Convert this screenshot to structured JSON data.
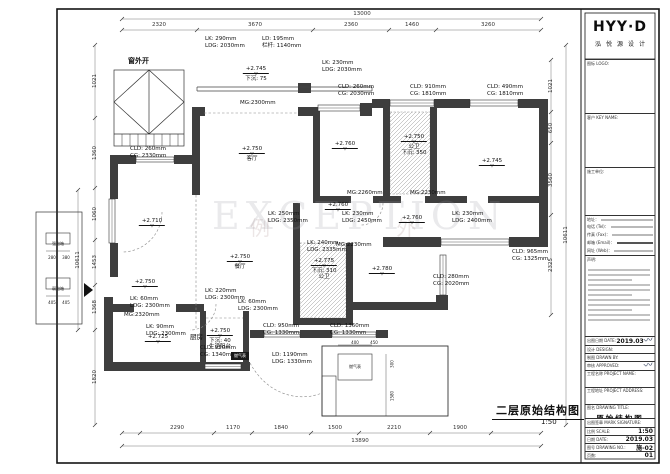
{
  "watermark": {
    "text": "EXCEPTION",
    "cn": "例 外"
  },
  "plan": {
    "title": "二层原始结构图",
    "scale": "1:50",
    "window_note": "窗外开",
    "gas_chip": "燃气表",
    "leaders": [
      {
        "x": 205,
        "y": 36,
        "l1": "LK: 290mm",
        "l2": "LDG: 2030mm"
      },
      {
        "x": 262,
        "y": 36,
        "l1": "LD: 195mm",
        "l2": "栏杆: 1140mm"
      },
      {
        "x": 322,
        "y": 60,
        "l1": "LK: 230mm",
        "l2": "LDG: 2030mm"
      },
      {
        "x": 338,
        "y": 84,
        "l1": "CLD: 260mm",
        "l2": "CG: 2030mm"
      },
      {
        "x": 410,
        "y": 84,
        "l1": "CLD: 910mm",
        "l2": "CG: 1810mm"
      },
      {
        "x": 487,
        "y": 84,
        "l1": "CLD: 490mm",
        "l2": "CG: 1810mm"
      },
      {
        "x": 130,
        "y": 146,
        "l1": "CLD: 260mm",
        "l2": "CG: 2330mm"
      },
      {
        "x": 268,
        "y": 211,
        "l1": "LK: 250mm",
        "l2": "LDG: 2350mm"
      },
      {
        "x": 342,
        "y": 211,
        "l1": "LK: 230mm",
        "l2": "LDG: 2450mm"
      },
      {
        "x": 452,
        "y": 211,
        "l1": "LK: 230mm",
        "l2": "LDG: 2400mm"
      },
      {
        "x": 307,
        "y": 240,
        "l1": "LK: 240mm",
        "l2": "LDG: 2335mm"
      },
      {
        "x": 205,
        "y": 288,
        "l1": "LK: 220mm",
        "l2": "LDG: 2300mm"
      },
      {
        "x": 238,
        "y": 299,
        "l1": "LK: 60mm",
        "l2": "LDG: 2300mm"
      },
      {
        "x": 130,
        "y": 296,
        "l1": "LK: 60mm",
        "l2": "LDG: 2300mm"
      },
      {
        "x": 146,
        "y": 324,
        "l1": "LK: 90mm",
        "l2": "LDG: 2300mm"
      },
      {
        "x": 200,
        "y": 345,
        "l1": "CLD: 950mm",
        "l2": "CG: 1340mm"
      },
      {
        "x": 263,
        "y": 323,
        "l1": "CLD: 950mm",
        "l2": "CG: 1330mm"
      },
      {
        "x": 330,
        "y": 323,
        "l1": "CLD: 1360mm",
        "l2": "CG: 1330mm"
      },
      {
        "x": 272,
        "y": 352,
        "l1": "LD: 1190mm",
        "l2": "LDG: 1330mm"
      },
      {
        "x": 433,
        "y": 274,
        "l1": "CLD: 280mm",
        "l2": "CG: 2020mm"
      },
      {
        "x": 512,
        "y": 249,
        "l1": "CLD: 965mm",
        "l2": "CG: 1325mm"
      }
    ],
    "levels": [
      {
        "x": 256,
        "y": 66,
        "v": "+2.745",
        "sub": [
          "下沉: 75"
        ]
      },
      {
        "x": 252,
        "y": 146,
        "v": "+2.750",
        "sub": [
          "客厅"
        ]
      },
      {
        "x": 152,
        "y": 218,
        "v": "+2.710",
        "sub": []
      },
      {
        "x": 345,
        "y": 141,
        "v": "+2.760",
        "sub": []
      },
      {
        "x": 414,
        "y": 134,
        "v": "+2.750",
        "sub": [
          "公卫",
          "下沉: 350"
        ]
      },
      {
        "x": 492,
        "y": 158,
        "v": "+2.745",
        "sub": []
      },
      {
        "x": 338,
        "y": 202,
        "v": "+2.760",
        "sub": []
      },
      {
        "x": 412,
        "y": 215,
        "v": "+2.760",
        "sub": []
      },
      {
        "x": 240,
        "y": 254,
        "v": "+2.750",
        "sub": [
          "餐厅"
        ]
      },
      {
        "x": 324,
        "y": 258,
        "v": "+2.775",
        "sub": [
          "下沉: 310",
          "公卫"
        ]
      },
      {
        "x": 382,
        "y": 266,
        "v": "+2.780",
        "sub": []
      },
      {
        "x": 145,
        "y": 279,
        "v": "+2.750",
        "sub": []
      },
      {
        "x": 158,
        "y": 334,
        "v": "+2.725",
        "sub": []
      },
      {
        "x": 220,
        "y": 328,
        "v": "+2.750",
        "sub": [
          "下沉: 40",
          "生活阳台"
        ]
      }
    ],
    "mg_labels": [
      {
        "x": 240,
        "y": 100,
        "t": "MG:2300mm"
      },
      {
        "x": 347,
        "y": 190,
        "t": "MG:2260mm"
      },
      {
        "x": 410,
        "y": 190,
        "t": "MG:2230mm"
      },
      {
        "x": 336,
        "y": 242,
        "t": "MG:2230mm"
      },
      {
        "x": 124,
        "y": 312,
        "t": "MG:2320mm"
      }
    ],
    "rooms": [
      {
        "x": 190,
        "y": 331,
        "t": "厨房"
      }
    ],
    "dims": {
      "top_total": "13000",
      "bottom_total": "13890",
      "top": [
        {
          "x": 159,
          "t": "2320"
        },
        {
          "x": 255,
          "t": "3670"
        },
        {
          "x": 351,
          "t": "2360"
        },
        {
          "x": 412,
          "t": "1460"
        },
        {
          "x": 488,
          "t": "3260"
        }
      ],
      "bottom": [
        {
          "x": 177,
          "t": "2290"
        },
        {
          "x": 233,
          "t": "1170"
        },
        {
          "x": 281,
          "t": "1840"
        },
        {
          "x": 335,
          "t": "1500"
        },
        {
          "x": 394,
          "t": "2210"
        },
        {
          "x": 460,
          "t": "1900"
        }
      ],
      "left": [
        {
          "x": 95,
          "y": 81,
          "t": "1021"
        },
        {
          "x": 95,
          "y": 153,
          "t": "1360"
        },
        {
          "x": 95,
          "y": 214,
          "t": "1060"
        },
        {
          "x": 95,
          "y": 262,
          "t": "1453"
        },
        {
          "x": 95,
          "y": 307,
          "t": "1368"
        },
        {
          "x": 95,
          "y": 377,
          "t": "1820"
        },
        {
          "x": 78,
          "y": 260,
          "t": "10611"
        }
      ],
      "right": [
        {
          "x": 551,
          "y": 86,
          "t": "1021"
        },
        {
          "x": 551,
          "y": 128,
          "t": "650"
        },
        {
          "x": 551,
          "y": 180,
          "t": "3560"
        },
        {
          "x": 551,
          "y": 265,
          "t": "2325"
        },
        {
          "x": 566,
          "y": 235,
          "t": "10611"
        }
      ]
    },
    "tiny_labels": [
      {
        "x": 355,
        "y": 340,
        "t": "400"
      },
      {
        "x": 374,
        "y": 340,
        "t": "450"
      },
      {
        "x": 392,
        "y": 364,
        "t": "300",
        "r": 1
      },
      {
        "x": 392,
        "y": 396,
        "t": "1580",
        "r": 1
      },
      {
        "x": 355,
        "y": 364,
        "t": "燃气表"
      },
      {
        "x": 58,
        "y": 241,
        "t": "强电箱"
      },
      {
        "x": 58,
        "y": 286,
        "t": "弱电箱"
      },
      {
        "x": 52,
        "y": 255,
        "t": "280"
      },
      {
        "x": 66,
        "y": 255,
        "t": "380"
      },
      {
        "x": 52,
        "y": 300,
        "t": "405"
      },
      {
        "x": 66,
        "y": 300,
        "t": "405"
      }
    ]
  },
  "titleblock": {
    "logo": "HYY·D",
    "logo_sub": "泓悦源设计",
    "cells": [
      {
        "label": "图标 LOGO:"
      },
      {
        "label": "客户 KEY NAME:"
      },
      {
        "label": "施工单位:"
      }
    ],
    "contact_labels": [
      "地址：",
      "电话 (Tel)：",
      "传真 (Fax)：",
      "邮箱 (Email)：",
      "网址 (Web)："
    ],
    "notes_label": "声明:",
    "fields": [
      {
        "label": "出图日期 DATE:",
        "value": "2019.03",
        "stamp": true
      },
      {
        "label": "设计 DESIGN:",
        "value": ""
      },
      {
        "label": "制图 DRAWN BY:",
        "value": ""
      },
      {
        "label": "审核 APPROVED:",
        "value": "",
        "stamp": true
      },
      {
        "label": "工程名称 PROJECT NAME:",
        "value": "",
        "tall": true
      },
      {
        "label": "工程地址 PROJECT ADDRESS:",
        "value": "",
        "tall": true
      },
      {
        "label": "图名 DRAWING TITLE:",
        "value": "原始结构图",
        "big": true
      },
      {
        "label": "出图签章 MARK SIGNATURE:",
        "value": ""
      },
      {
        "label": "比例 SCALE:",
        "value": "1:50"
      },
      {
        "label": "日期 DATE:",
        "value": "2019.03"
      },
      {
        "label": "图号 DRAWING NO.:",
        "value": "施-02"
      },
      {
        "label": "页数:",
        "value": "01"
      }
    ]
  }
}
